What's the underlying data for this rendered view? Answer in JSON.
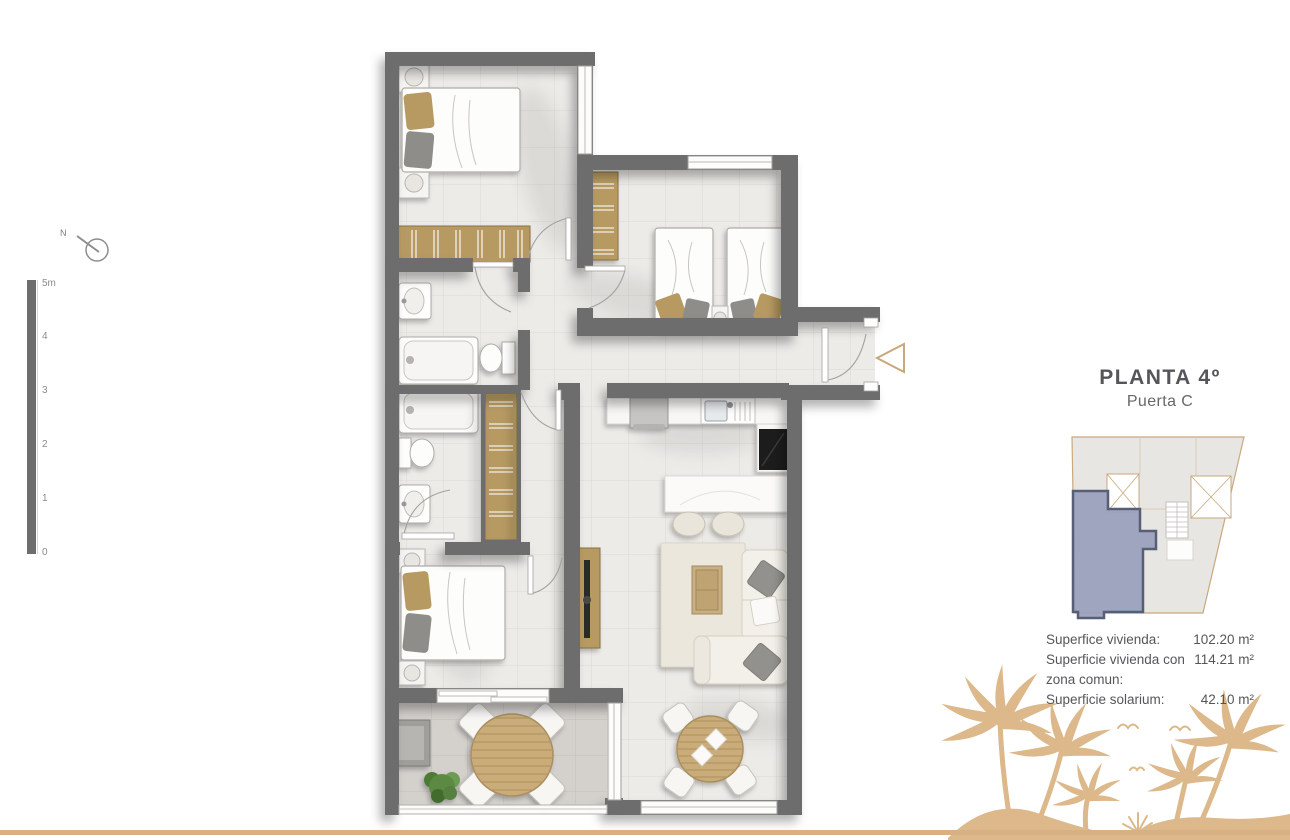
{
  "header": {
    "title": "PLANTA 4º",
    "subtitle": "Puerta C"
  },
  "surface_info": {
    "rows": [
      {
        "label": "Superfice vivienda:",
        "value": "102.20 m²"
      },
      {
        "label": "Superficie vivienda con zona comun:",
        "value": "114.21 m²"
      },
      {
        "label": "Superficie solarium:",
        "value": "42.10 m²"
      }
    ]
  },
  "north_indicator": {
    "label": "N"
  },
  "scale_bar": {
    "labels": [
      "5m",
      "4",
      "3",
      "2",
      "1",
      "0"
    ]
  },
  "colors": {
    "accent_gold": "#d7b183",
    "wall_gray": "#6e6d6d",
    "unit_highlight_fill": "#98a0bc",
    "unit_highlight_border": "#575f76",
    "text": "#55565a"
  }
}
